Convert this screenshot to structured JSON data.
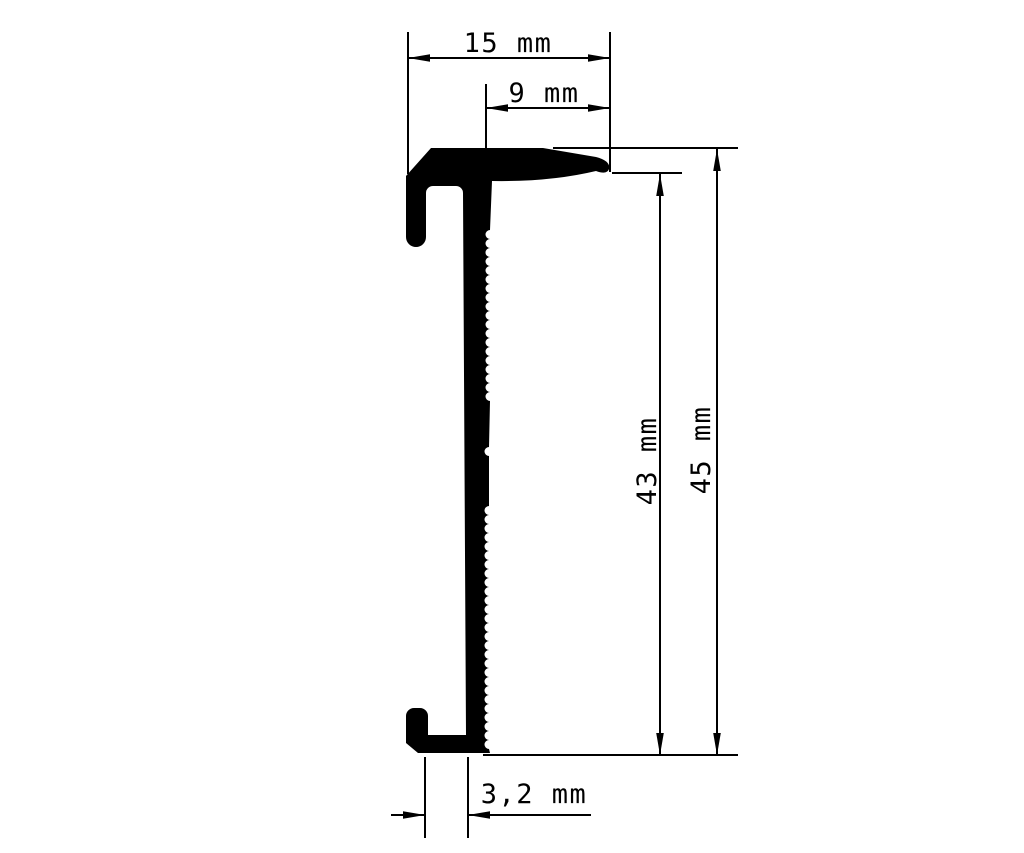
{
  "drawing": {
    "type": "profile-cross-section-technical-drawing",
    "unit": "mm",
    "colors": {
      "background": "#ffffff",
      "ink": "#000000"
    },
    "labels": {
      "top_width": "15 mm",
      "nose_width": "9 mm",
      "inner_height": "43 mm",
      "total_height": "45 mm",
      "slot_width": "3,2 mm"
    },
    "values": {
      "top_width_mm": 15,
      "nose_width_mm": 9,
      "inner_height_mm": 43,
      "total_height_mm": 45,
      "slot_width_mm": 3.2
    }
  }
}
